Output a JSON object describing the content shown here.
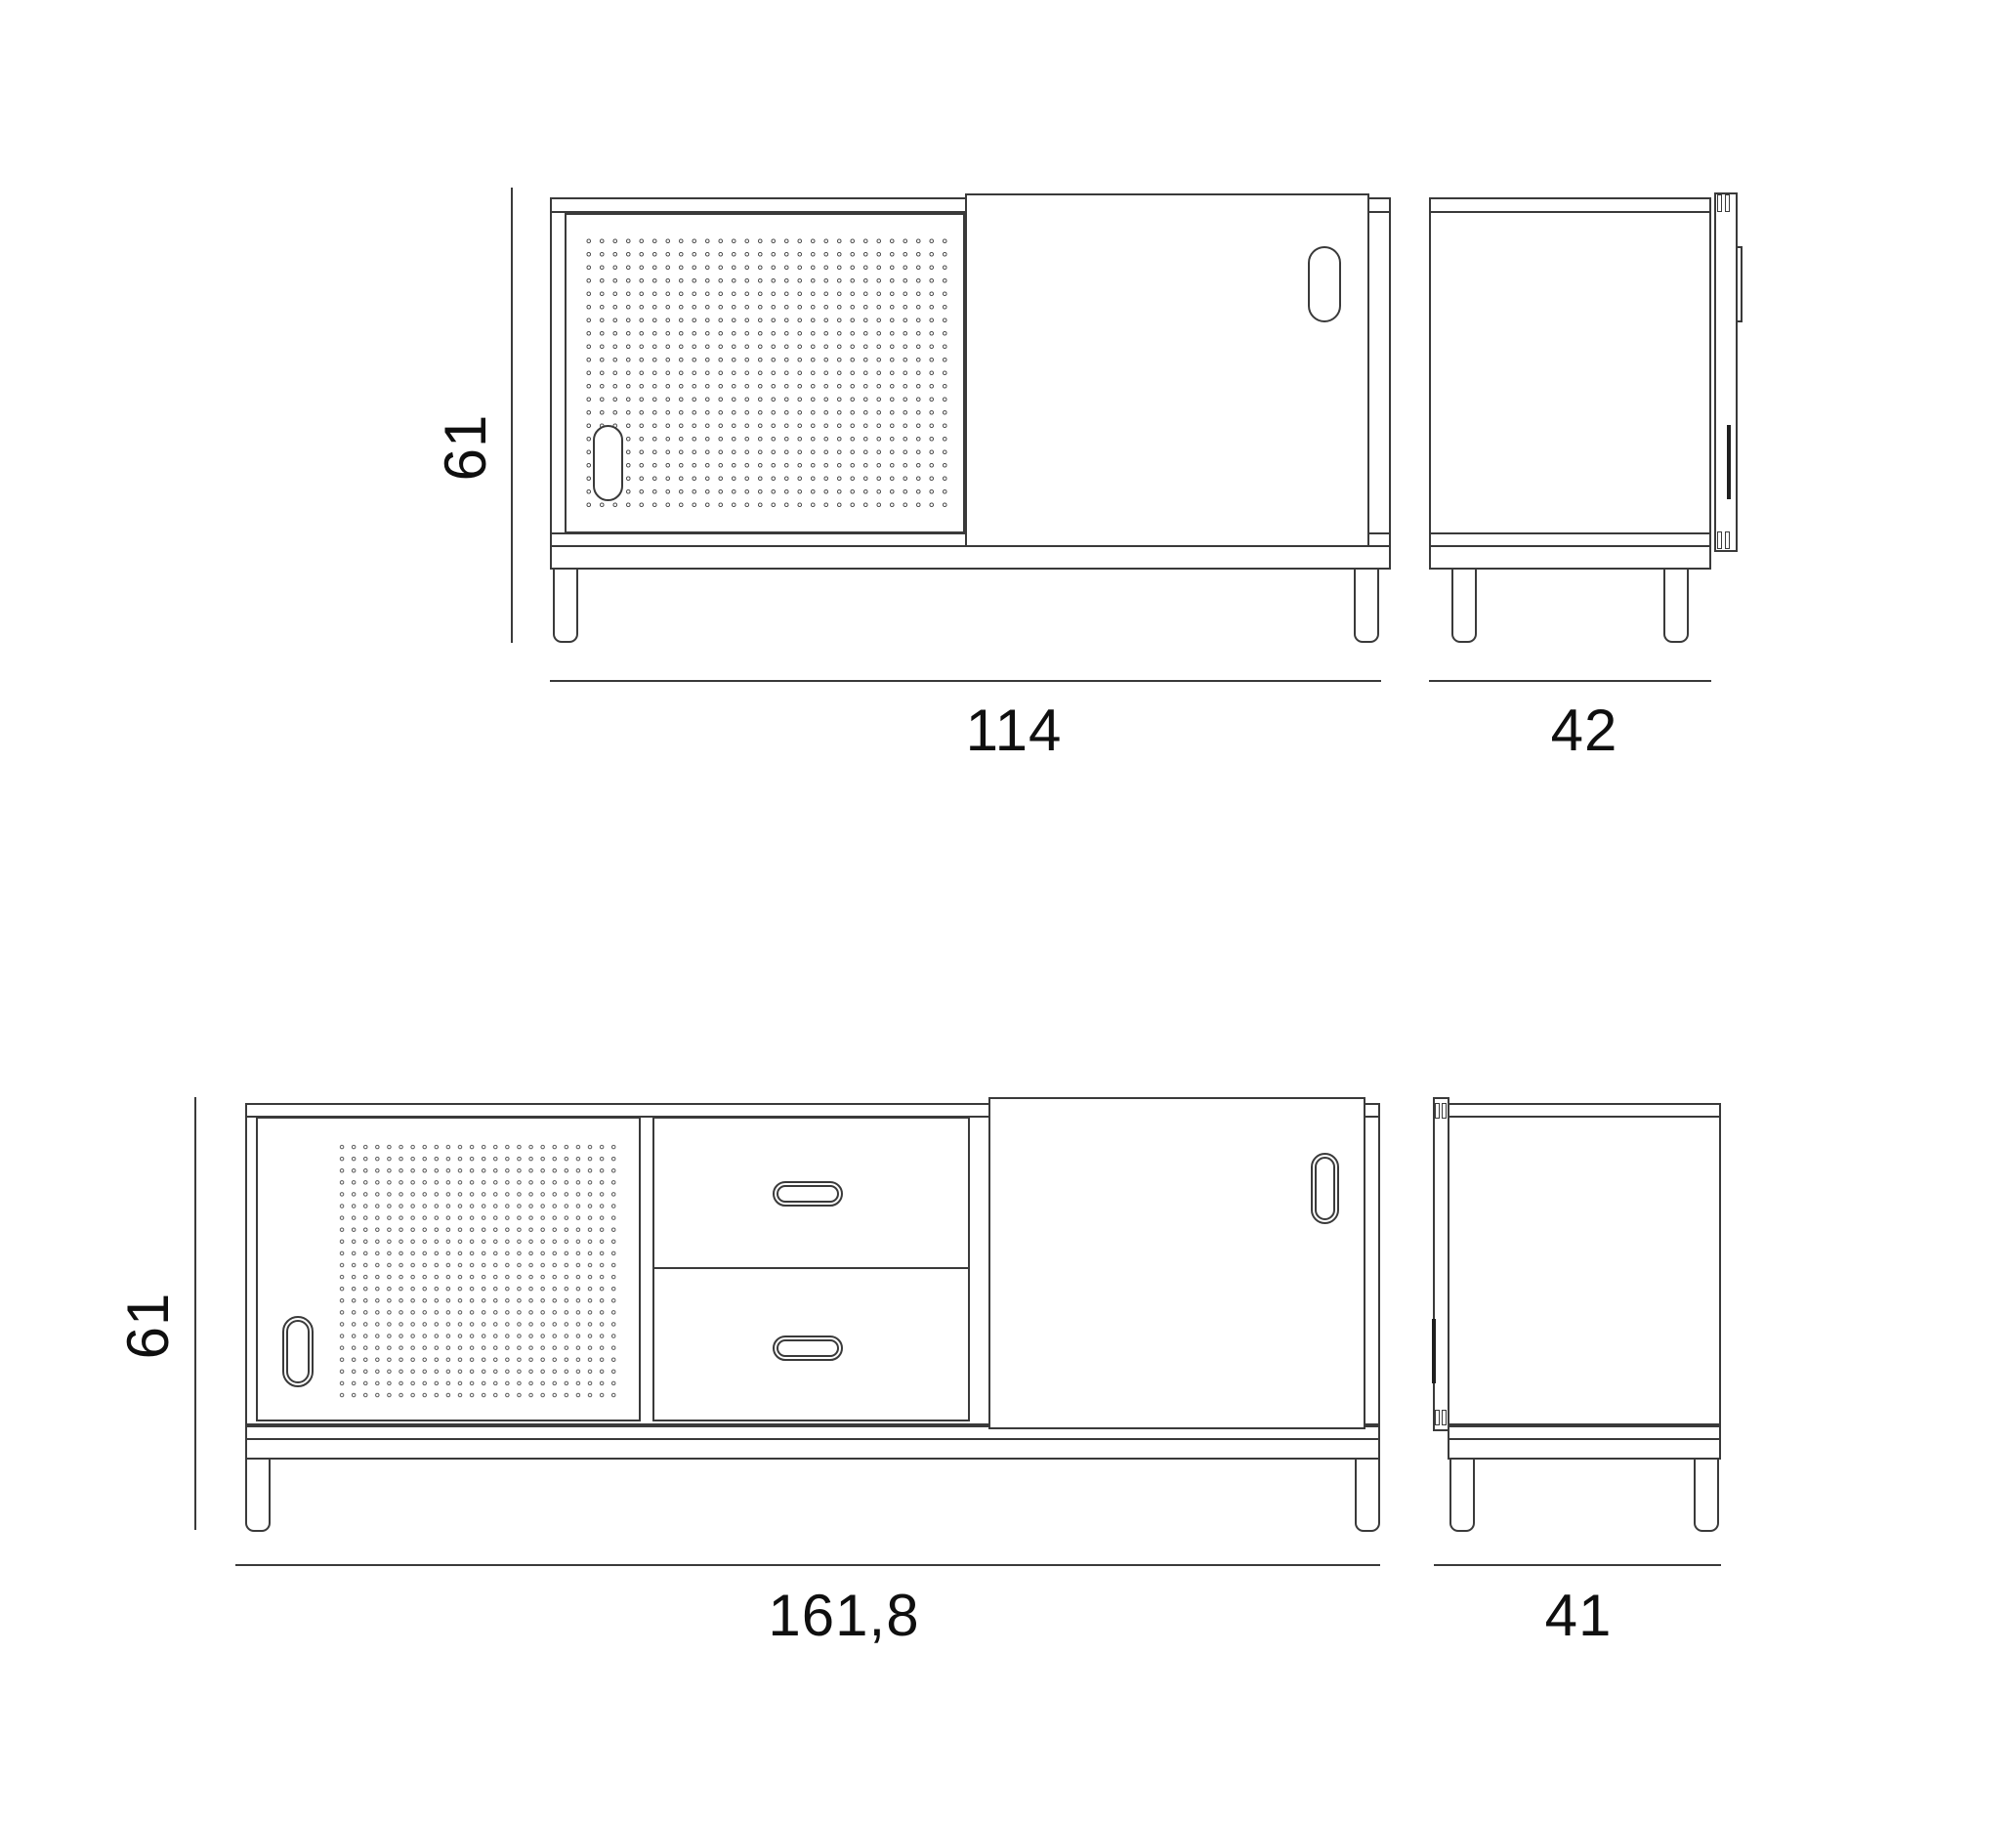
{
  "drawing": {
    "line_color": "#3a3a3a",
    "views": {
      "top_front": {
        "height_label": "61",
        "width_label": "114"
      },
      "top_side": {
        "width_label": "42"
      },
      "bottom_front": {
        "height_label": "61",
        "width_label": "161,8"
      },
      "bottom_side": {
        "width_label": "41"
      }
    }
  }
}
